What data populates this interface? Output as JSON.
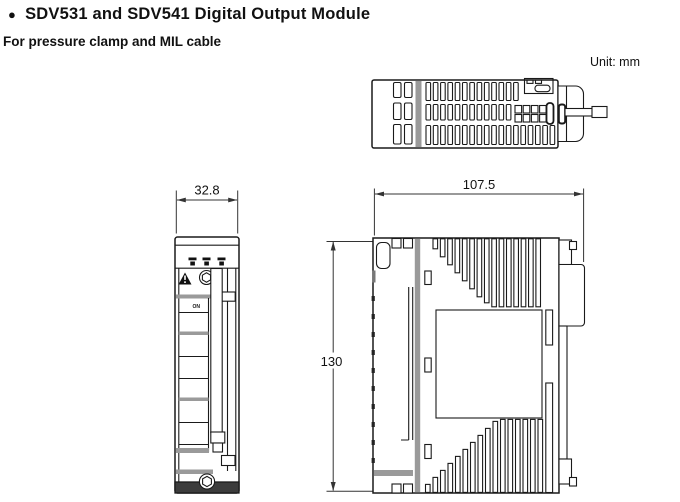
{
  "header": {
    "bullet": "●",
    "title": "SDV531 and SDV541 Digital Output Module",
    "subtitle": "For pressure clamp and MIL cable",
    "unit_label": "Unit: mm"
  },
  "dimensions": {
    "front_width_mm": "32.8",
    "overall_depth_mm": "107.5",
    "overall_height_mm": "130"
  },
  "front_view": {
    "switch_label": "ON"
  },
  "colors": {
    "line": "#1a1a1a",
    "gray_bar": "#9a9a9a",
    "background": "#ffffff"
  }
}
